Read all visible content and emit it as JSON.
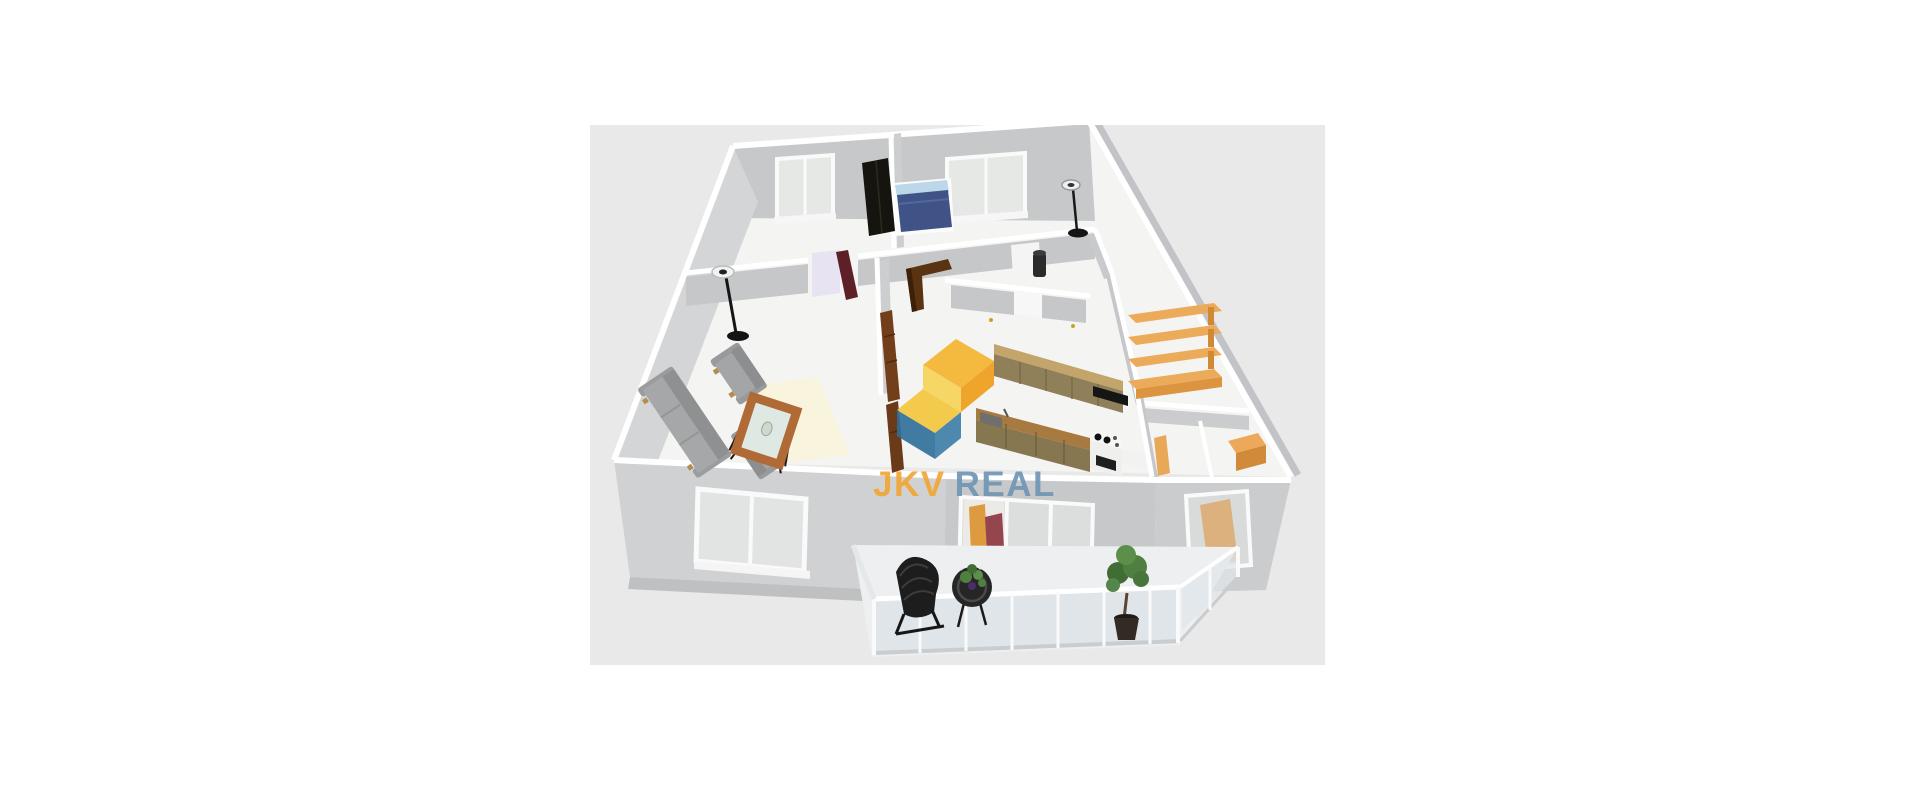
{
  "page": {
    "background": "#ffffff"
  },
  "canvas": {
    "background": "#e9e9e9",
    "description": "3D isometric floor plan rendering of an apartment with furniture and a balcony",
    "x": 590,
    "y": 125,
    "width": 735,
    "height": 540
  },
  "watermark": {
    "text_primary": "JKV",
    "text_secondary": "REAL",
    "color_primary": "#f2a531",
    "color_secondary": "#6e94b4",
    "logo": {
      "yellow": "#f5b32c",
      "orange": "#ef9c17",
      "light_yellow": "#f7d457",
      "blue": "#3c7ea8",
      "teal": "#2f6f99"
    },
    "opacity": 0.9
  },
  "colors": {
    "wall_top": "#ffffff",
    "wall_face": "#c7c8ca",
    "wall_face_light": "#d4d5d7",
    "floor": "#f4f4f3",
    "bed": "#3f5387",
    "bed_headboard": "#bcd7e9",
    "wardrobe": "#16140f",
    "sofa": "#a6a7a9",
    "rug": "#f8f4dd",
    "door_maroon": "#5c2026",
    "doorway_lavender": "#e7e3f2",
    "cabinet_khaki": "#8f805a",
    "counter_wood": "#a87a40",
    "shelf_orange": "#ecab5b",
    "desk_orange": "#e9a758",
    "hall_cabinet_brown": "#733f1b",
    "hall_desk_dark": "#5a3312",
    "glass_railing": "#d9e2e6",
    "plant_green": "#4f8040"
  },
  "scene": {
    "rooms": [
      {
        "name": "bedroom-left",
        "furniture": [
          "double window",
          "black wardrobe"
        ]
      },
      {
        "name": "bedroom-right",
        "furniture": [
          "blue double bed",
          "double window",
          "floor lamp"
        ]
      },
      {
        "name": "living-room",
        "furniture": [
          "sofa",
          "armchair",
          "armchair",
          "coffee table",
          "rug",
          "floor lamp",
          "maroon door"
        ]
      },
      {
        "name": "hallway",
        "furniture": [
          "dark corner desk",
          "brown sideboard",
          "water heater"
        ]
      },
      {
        "name": "kitchen",
        "furniture": [
          "wall cabinets",
          "counter with sink",
          "stove with oven",
          "black hob"
        ]
      },
      {
        "name": "storage-room",
        "furniture": [
          "orange shelving unit (4 shelves)"
        ]
      },
      {
        "name": "room-bottom-right",
        "furniture": [
          "orange desk",
          "orange counter",
          "window"
        ]
      },
      {
        "name": "balcony",
        "furniture": [
          "wicker chair",
          "round wicker table with plant",
          "potted tree",
          "glass railing"
        ]
      }
    ]
  }
}
